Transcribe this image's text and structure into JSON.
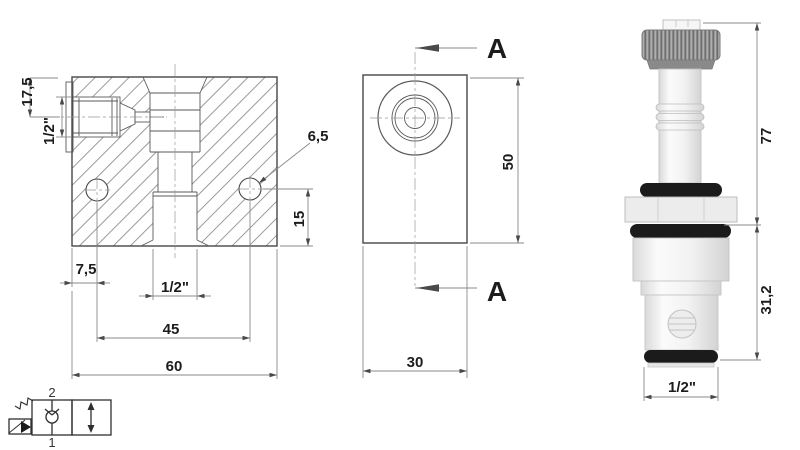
{
  "colors": {
    "line": "#474747",
    "dimension_line": "#8a8a8a",
    "hatch": "#9a9a9a",
    "oring_black": "#1b1b1b",
    "cap_gray": "#9c9c9c",
    "background": "#ffffff"
  },
  "front_view": {
    "dim_top_offset": "17,5",
    "dim_side_port_thread": "1/2\"",
    "dim_hole_diameter": "6,5",
    "dim_hole_to_bottom": "15",
    "dim_edge_to_hole": "7,5",
    "dim_cavity_thread": "1/2\"",
    "dim_hole_spacing": "45",
    "dim_block_width": "60"
  },
  "side_view": {
    "section_label_top": "A",
    "section_label_bottom": "A",
    "dim_block_height": "50",
    "dim_block_depth": "30"
  },
  "cartridge": {
    "dim_total_height": "77",
    "dim_cartridge_length": "31,2",
    "dim_thread": "1/2\""
  },
  "symbol": {
    "port_top": "2",
    "port_bottom": "1"
  }
}
